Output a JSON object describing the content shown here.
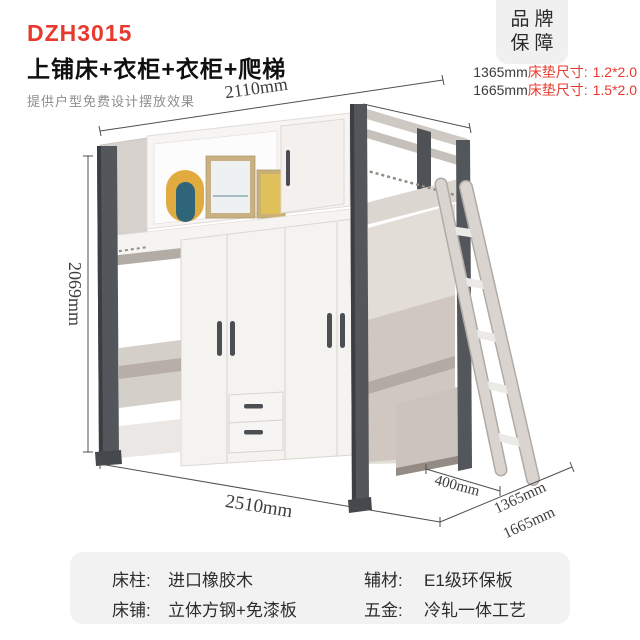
{
  "header": {
    "model": "DZH3015",
    "title": "上铺床+衣柜+衣柜+爬梯",
    "subtitle": "提供户型免费设计摆放效果"
  },
  "badge": {
    "line1": "品牌",
    "line2": "保障"
  },
  "mattress_specs": [
    {
      "width": "1365mm",
      "label": "床垫尺寸:",
      "size": "1.2*2.0"
    },
    {
      "width": "1665mm",
      "label": "床垫尺寸:",
      "size": "1.5*2.0"
    }
  ],
  "dimensions": {
    "width_top": "2110mm",
    "height_left": "2069mm",
    "width_bottom": "2510mm",
    "ladder_depth": "400mm",
    "depth_a": "1365mm",
    "depth_b": "1665mm"
  },
  "specs_table": {
    "rows": [
      [
        {
          "label": "床柱:",
          "value": "进口橡胶木"
        },
        {
          "label": "辅材:",
          "value": "E1级环保板"
        }
      ],
      [
        {
          "label": "床铺:",
          "value": "立体方钢+免漆板"
        },
        {
          "label": "五金:",
          "value": "冷轧一体工艺"
        }
      ]
    ]
  },
  "colors": {
    "accent_red": "#e8392e",
    "post_dark": "#53565a",
    "rail_light": "#cfc9c3",
    "panel_white": "#f5f3f1",
    "badge_bg": "#f0f0f1",
    "table_bg": "#f2f2f3",
    "dimension_text": "#3d3d3d"
  }
}
